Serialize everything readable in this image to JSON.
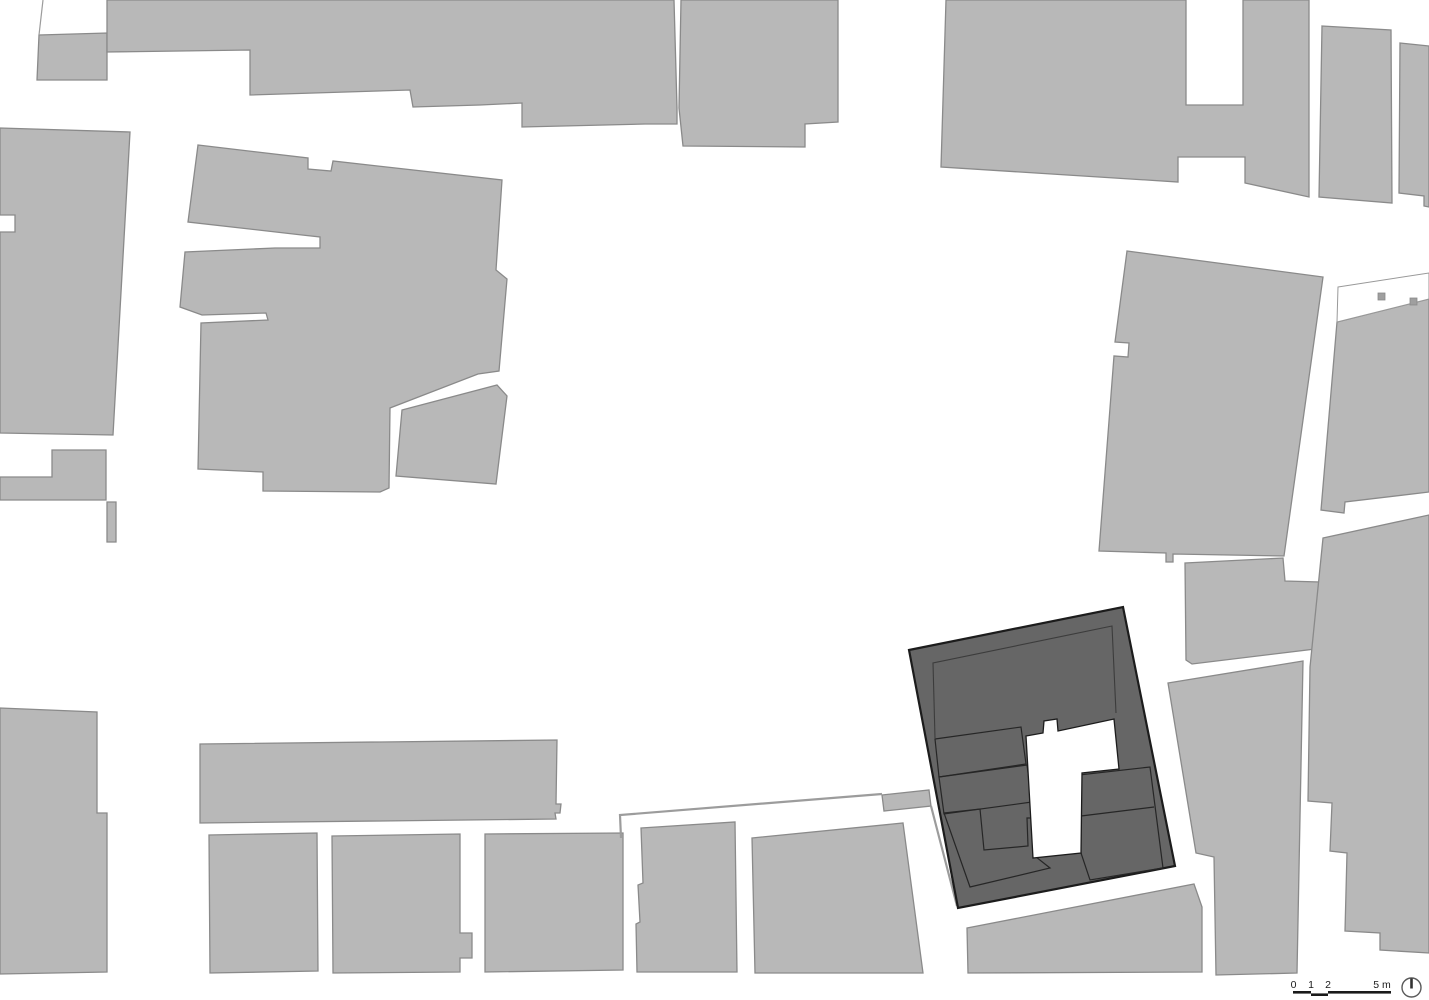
{
  "meta": {
    "type": "architectural-site-plan",
    "canvas_w": 1429,
    "canvas_h": 1000
  },
  "palette": {
    "bg": "#ffffff",
    "bld": "#b8b8b8",
    "bld_edge": "#8a8a8a",
    "dark": "#666666",
    "dark_edge": "#1c1c1c",
    "room_line": "#262626",
    "inset_line": "#3c3c3c",
    "wall": "#9c9c9c",
    "ink": "#1a1a1a",
    "plot_edge": "#999999",
    "sq": "#9f9f9f"
  },
  "plan": {
    "context_buildings": [
      {
        "name": "building-nw-corner-block",
        "pts": "39,35 107,33 107,80 37,80"
      },
      {
        "name": "building-top-band-west",
        "pts": "107,0 674,0 677,108 677,124 645,124 522,127 522,103 480,105 413,107 410,90 250,95 250,50 107,52"
      },
      {
        "name": "building-top-band-east",
        "pts": "681,0 838,0 838,122 805,124 805,147 683,146 679,108"
      },
      {
        "name": "building-top-right-block",
        "pts": "946,0 1186,0 1186,105 1243,105 1243,0 1309,0 1309,197 1245,183 1245,157 1178,157 1178,182 941,167"
      },
      {
        "name": "building-top-far-right-a",
        "pts": "1322,26 1391,30 1392,203 1319,197"
      },
      {
        "name": "building-top-far-right-b",
        "pts": "1400,43 1429,46 1429,207 1424,206 1424,196 1399,193"
      },
      {
        "name": "building-center-left-complex",
        "pts": "198,145 308,158 308,169 331,171 333,161 502,180 496,270 507,279 499,371 478,374 390,408 389,488 380,492 263,491 263,472 198,469 201,323 268,320 266,313 202,315 180,307 185,252 275,248 320,248 320,237 302,235 188,222"
      },
      {
        "name": "building-center-annex",
        "pts": "402,410 497,385 507,396 496,484 396,476"
      },
      {
        "name": "building-left-mid",
        "pts": "0,128 130,132 113,435 0,433 0,232 15,232 15,215 0,215"
      },
      {
        "name": "building-left-step",
        "pts": "52,450 106,450 106,500 0,500 0,477 52,477"
      },
      {
        "name": "building-left-sliver",
        "pts": "107,502 116,502 116,542 107,542"
      },
      {
        "name": "building-left-bottom",
        "pts": "0,708 97,712 97,813 107,813 107,972 0,974"
      },
      {
        "name": "building-long-row",
        "pts": "200,744 557,740 556,804 561,804 560,813 555,813 556,819 200,823"
      },
      {
        "name": "building-bottom-a",
        "pts": "209,835 317,833 318,971 210,973"
      },
      {
        "name": "building-bottom-b",
        "pts": "332,836 460,834 460,933 472,933 472,958 460,958 460,972 333,973"
      },
      {
        "name": "building-bottom-c",
        "pts": "485,834 623,833 623,970 485,972"
      },
      {
        "name": "building-bottom-d",
        "pts": "641,828 735,822 737,972 637,972 636,924 640,922 638,885 643,883"
      },
      {
        "name": "building-bottom-e",
        "pts": "752,838 903,823 923,973 755,973"
      },
      {
        "name": "building-bottom-f",
        "pts": "967,928 1194,884 1202,907 1202,972 968,973"
      },
      {
        "name": "building-center-right-tall",
        "pts": "1127,251 1323,277 1284,556 1173,554 1173,562 1166,562 1166,553 1099,551 1114,356 1128,357 1129,343 1115,342"
      },
      {
        "name": "building-east-of-subject-upper",
        "pts": "1185,563 1283,558 1285,581 1320,582 1315,649 1192,664 1186,660"
      },
      {
        "name": "building-east-of-subject-lower",
        "pts": "1168,683 1303,661 1297,973 1216,975 1214,857 1196,853"
      },
      {
        "name": "building-right-edge-upper",
        "pts": "1337,322 1429,299 1429,492 1345,502 1344,513 1321,510"
      },
      {
        "name": "building-right-edge-lower",
        "pts": "1323,538 1429,515 1429,953 1380,950 1380,933 1345,931 1347,853 1330,851 1332,803 1308,801 1310,667"
      },
      {
        "name": "garden-hut",
        "pts": "882,795 929,790 931,806 884,811"
      }
    ],
    "parcel_lines": [
      {
        "name": "parcel-line-nw",
        "pts": "43,0 39,35",
        "w": 1.2
      },
      {
        "name": "garden-wall-west",
        "pts": "621,838 620,815 882,794",
        "w": 2.2
      },
      {
        "name": "garden-wall-east",
        "pts": "931,806 957,906",
        "w": 2.2
      }
    ],
    "white_plots": [
      {
        "name": "open-plot-right-edge",
        "pts": "1338,287 1429,273 1429,299 1337,322"
      }
    ],
    "plot_squares": [
      {
        "name": "plot-shed-a",
        "x": 1378,
        "y": 293,
        "w": 7,
        "h": 7
      },
      {
        "name": "plot-shed-b",
        "x": 1410,
        "y": 298,
        "w": 7,
        "h": 7
      }
    ],
    "subject": {
      "outer": {
        "name": "subject-building-footprint",
        "pts": "909,650 1123,607 1175,866 958,908"
      },
      "inset_line": {
        "name": "subject-roof-inset-line",
        "pts": "935,738 933,663 1112,626 1116,713"
      },
      "rooms": [
        {
          "name": "subject-room-upper-left",
          "pts": "935,739 1021,727 1026,764 939,777"
        },
        {
          "name": "subject-room-mid-left",
          "pts": "939,777 1027,765 1032,802 944,814"
        },
        {
          "name": "subject-room-lower-left-L",
          "pts": "944,813 980,809 984,850 1028,846 1027,818 1033,818 1036,857 1050,868 970,887"
        },
        {
          "name": "subject-room-right-block",
          "pts": "1079,775 1150,767 1163,868 1090,880 1081,853"
        }
      ],
      "dividers": [
        {
          "name": "subject-room-divider",
          "pts": "1081,816 1154,807"
        }
      ],
      "courtyard": {
        "name": "subject-courtyard",
        "pts": "1026,736 1043,733 1044,721 1057,719 1058,731 1114,719 1119,769 1082,773 1081,853 1033,858"
      }
    }
  },
  "scale_bar": {
    "labels": [
      {
        "text": "0",
        "x": 1293.5
      },
      {
        "text": "1",
        "x": 1311
      },
      {
        "text": "2",
        "x": 1328
      },
      {
        "text": "5 m",
        "x": 1382
      }
    ],
    "label_y": 988,
    "segments": [
      {
        "x": 1293,
        "y": 991,
        "w": 18,
        "h": 2.6
      },
      {
        "x": 1311,
        "y": 993.4,
        "w": 17,
        "h": 2.6
      },
      {
        "x": 1328,
        "y": 991,
        "w": 63,
        "h": 2.6
      }
    ]
  },
  "north_arrow": {
    "cx": 1411.5,
    "cy": 987.5,
    "r": 9.5,
    "needle_len": 9
  }
}
